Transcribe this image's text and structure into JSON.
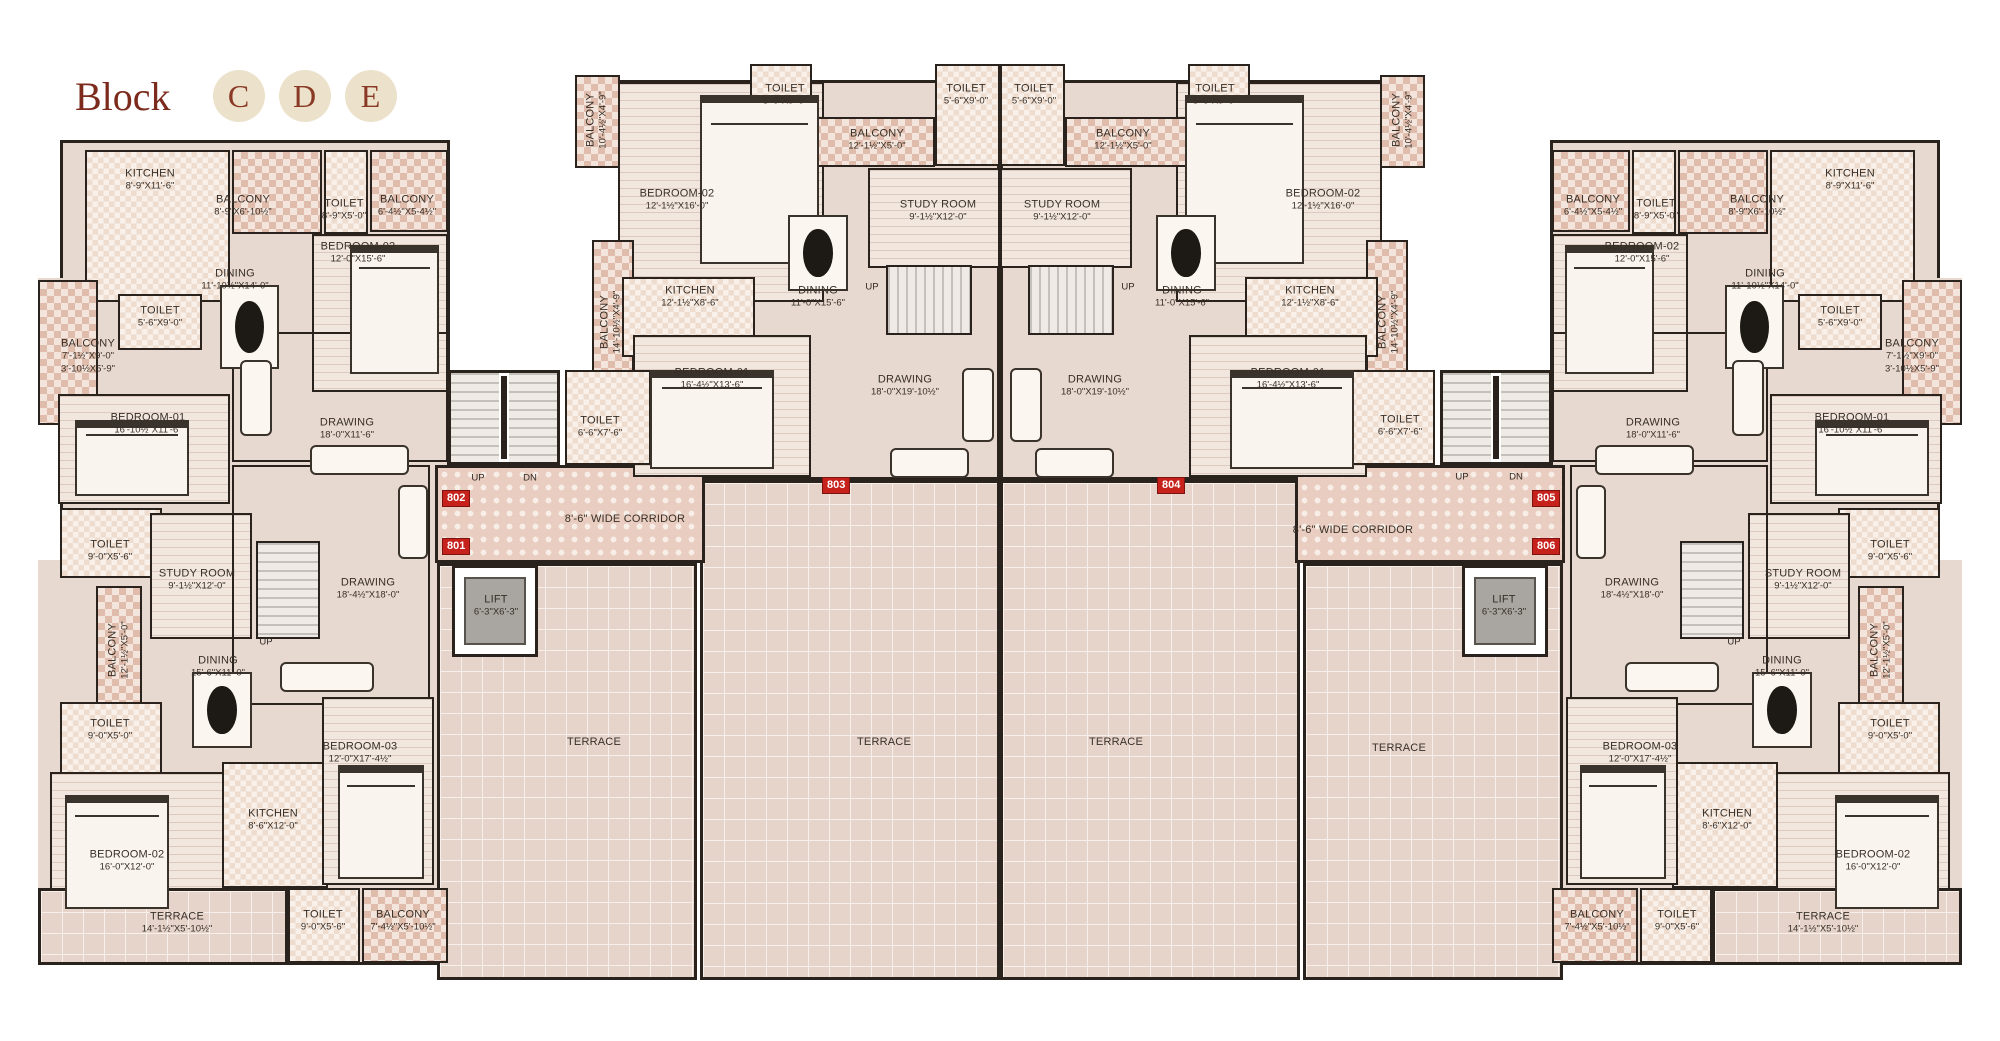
{
  "title": {
    "text": "Block",
    "badges": [
      "C",
      "D",
      "E"
    ]
  },
  "colors": {
    "accent": "#7b2a1c",
    "badge_bg": "#ece2cb",
    "unit_badge": "#c6211b",
    "wall": "#2a231d"
  },
  "unit_badges": [
    {
      "n": "802",
      "x": 442,
      "y": 490
    },
    {
      "n": "801",
      "x": 442,
      "y": 538
    },
    {
      "n": "803",
      "x": 822,
      "y": 477
    },
    {
      "n": "804",
      "x": 1157,
      "y": 477
    },
    {
      "n": "805",
      "x": 1532,
      "y": 490
    },
    {
      "n": "806",
      "x": 1532,
      "y": 538
    }
  ],
  "stair_labels": [
    {
      "t": "UP",
      "x": 478,
      "y": 478
    },
    {
      "t": "DN",
      "x": 530,
      "y": 478
    },
    {
      "t": "UP",
      "x": 1462,
      "y": 477
    },
    {
      "t": "DN",
      "x": 1516,
      "y": 477
    },
    {
      "t": "UP",
      "x": 872,
      "y": 287
    },
    {
      "t": "UP",
      "x": 1128,
      "y": 287
    },
    {
      "t": "UP",
      "x": 266,
      "y": 642
    },
    {
      "t": "UP",
      "x": 1734,
      "y": 642
    }
  ],
  "labels": [
    {
      "n": "KITCHEN",
      "d": "8'-9\"X11'-6\"",
      "x": 150,
      "y": 180
    },
    {
      "n": "BALCONY",
      "d": "8'-9\"X6'-10½\"",
      "x": 243,
      "y": 206
    },
    {
      "n": "TOILET",
      "d": "8'-9\"X5'-0\"",
      "x": 344,
      "y": 210
    },
    {
      "n": "BALCONY",
      "d": "6'-4½\"X5-4½\"",
      "x": 407,
      "y": 206
    },
    {
      "n": "BEDROOM-02",
      "d": "12'-0\"X15'-6\"",
      "x": 358,
      "y": 253
    },
    {
      "n": "DINING",
      "d": "11'-10½\"X14'-0\"",
      "x": 235,
      "y": 280
    },
    {
      "n": "TOILET",
      "d": "5'-6\"X9'-0\"",
      "x": 160,
      "y": 317
    },
    {
      "n": "BALCONY",
      "d": "7'-1½\"X9'-0\"",
      "d2": "3'-10½X5'-9\"",
      "x": 88,
      "y": 356
    },
    {
      "n": "BEDROOM-01",
      "d": "16'-10½\"X11'-6\"",
      "x": 148,
      "y": 424
    },
    {
      "n": "DRAWING",
      "d": "18'-0\"X11'-6\"",
      "x": 347,
      "y": 429
    },
    {
      "n": "TOILET",
      "d": "9'-0\"X5'-6\"",
      "x": 110,
      "y": 551
    },
    {
      "n": "STUDY ROOM",
      "d": "9'-1½\"X12'-0\"",
      "x": 197,
      "y": 580
    },
    {
      "n": "BALCONY",
      "d": "12'-1½\"X5'-0\"",
      "x": 119,
      "y": 650,
      "rot": true
    },
    {
      "n": "DINING",
      "d": "15'-6\"X11'-0\"",
      "x": 218,
      "y": 667
    },
    {
      "n": "TOILET",
      "d": "9'-0\"X5'-0\"",
      "x": 110,
      "y": 730
    },
    {
      "n": "DRAWING",
      "d": "18'-4½\"X18'-0\"",
      "x": 368,
      "y": 589
    },
    {
      "n": "BEDROOM-03",
      "d": "12'-0\"X17'-4½\"",
      "x": 360,
      "y": 753
    },
    {
      "n": "LIFT",
      "d": "6'-3\"X6'-3\"",
      "x": 496,
      "y": 606
    },
    {
      "n": "BEDROOM-02",
      "d": "16'-0\"X12'-0\"",
      "x": 127,
      "y": 861
    },
    {
      "n": "KITCHEN",
      "d": "8'-6\"X12'-0\"",
      "x": 273,
      "y": 820
    },
    {
      "n": "TERRACE",
      "d": "14'-1½\"X5'-10½\"",
      "x": 177,
      "y": 923
    },
    {
      "n": "TOILET",
      "d": "9'-0\"X5'-6\"",
      "x": 323,
      "y": 921
    },
    {
      "n": "BALCONY",
      "d": "7'-4½\"X5'-10½\"",
      "x": 403,
      "y": 921
    },
    {
      "n": "BALCONY",
      "d": "10'-4½\"X4'-9\"",
      "x": 597,
      "y": 120,
      "rot": true
    },
    {
      "n": "BEDROOM-02",
      "d": "12'-1½\"X16'-0\"",
      "x": 677,
      "y": 200
    },
    {
      "n": "TOILET",
      "d": "5'-0\"X9'-0\"",
      "x": 785,
      "y": 95
    },
    {
      "n": "BALCONY",
      "d": "12'-1½\"X5'-0\"",
      "x": 877,
      "y": 140
    },
    {
      "n": "TOILET",
      "d": "5'-6\"X9'-0\"",
      "x": 966,
      "y": 95
    },
    {
      "n": "STUDY ROOM",
      "d": "9'-1½\"X12'-0\"",
      "x": 938,
      "y": 211
    },
    {
      "n": "KITCHEN",
      "d": "12'-1½\"X8'-6\"",
      "x": 690,
      "y": 297
    },
    {
      "n": "DINING",
      "d": "11'-0\"X15'-6\"",
      "x": 818,
      "y": 297
    },
    {
      "n": "BALCONY",
      "d": "14'-10½\"X4'-9\"",
      "x": 611,
      "y": 322,
      "rot": true
    },
    {
      "n": "BEDROOM-01",
      "d": "16'-4½\"X13'-6\"",
      "x": 712,
      "y": 379
    },
    {
      "n": "DRAWING",
      "d": "18'-0\"X19'-10½\"",
      "x": 905,
      "y": 386
    },
    {
      "n": "TOILET",
      "d": "6'-6\"X7'-6\"",
      "x": 600,
      "y": 427
    },
    {
      "n": "BALCONY",
      "d": "10'-4½\"X4'-9\"",
      "x": 1403,
      "y": 120,
      "rot": true
    },
    {
      "n": "BEDROOM-02",
      "d": "12'-1½\"X16'-0\"",
      "x": 1323,
      "y": 200
    },
    {
      "n": "TOILET",
      "d": "5'-0\"X9'-0\"",
      "x": 1215,
      "y": 95
    },
    {
      "n": "BALCONY",
      "d": "12'-1½\"X5'-0\"",
      "x": 1123,
      "y": 140
    },
    {
      "n": "TOILET",
      "d": "5'-6\"X9'-0\"",
      "x": 1034,
      "y": 95
    },
    {
      "n": "STUDY ROOM",
      "d": "9'-1½\"X12'-0\"",
      "x": 1062,
      "y": 211
    },
    {
      "n": "KITCHEN",
      "d": "12'-1½\"X8'-6\"",
      "x": 1310,
      "y": 297
    },
    {
      "n": "DINING",
      "d": "11'-0\"X15'-6\"",
      "x": 1182,
      "y": 297
    },
    {
      "n": "BALCONY",
      "d": "14'-10½\"X4'-9\"",
      "x": 1389,
      "y": 322,
      "rot": true
    },
    {
      "n": "BEDROOM-01",
      "d": "16'-4½\"X13'-6\"",
      "x": 1288,
      "y": 379
    },
    {
      "n": "DRAWING",
      "d": "18'-0\"X19'-10½\"",
      "x": 1095,
      "y": 386
    },
    {
      "n": "TOILET",
      "d": "6'-6\"X7'-6\"",
      "x": 1400,
      "y": 426
    },
    {
      "n": "KITCHEN",
      "d": "8'-9\"X11'-6\"",
      "x": 1850,
      "y": 180
    },
    {
      "n": "BALCONY",
      "d": "8'-9\"X6'-10½\"",
      "x": 1757,
      "y": 206
    },
    {
      "n": "TOILET",
      "d": "8'-9\"X5'-0\"",
      "x": 1656,
      "y": 210
    },
    {
      "n": "BALCONY",
      "d": "6'-4½\"X5-4½\"",
      "x": 1593,
      "y": 206
    },
    {
      "n": "BEDROOM-02",
      "d": "12'-0\"X15'-6\"",
      "x": 1642,
      "y": 253
    },
    {
      "n": "DINING",
      "d": "11'-10½\"X14'-0\"",
      "x": 1765,
      "y": 280
    },
    {
      "n": "TOILET",
      "d": "5'-6\"X9'-0\"",
      "x": 1840,
      "y": 317
    },
    {
      "n": "BALCONY",
      "d": "7'-1½\"X9'-0\"",
      "d2": "3'-10½X5'-9\"",
      "x": 1912,
      "y": 356
    },
    {
      "n": "BEDROOM-01",
      "d": "16'-10½\"X11'-6\"",
      "x": 1852,
      "y": 424
    },
    {
      "n": "DRAWING",
      "d": "18'-0\"X11'-6\"",
      "x": 1653,
      "y": 429
    },
    {
      "n": "TOILET",
      "d": "9'-0\"X5'-6\"",
      "x": 1890,
      "y": 551
    },
    {
      "n": "STUDY ROOM",
      "d": "9'-1½\"X12'-0\"",
      "x": 1803,
      "y": 580
    },
    {
      "n": "BALCONY",
      "d": "12'-1½\"X5'-0\"",
      "x": 1881,
      "y": 650,
      "rot": true
    },
    {
      "n": "DINING",
      "d": "15'-6\"X11'-0\"",
      "x": 1782,
      "y": 667
    },
    {
      "n": "TOILET",
      "d": "9'-0\"X5'-0\"",
      "x": 1890,
      "y": 730
    },
    {
      "n": "DRAWING",
      "d": "18'-4½\"X18'-0\"",
      "x": 1632,
      "y": 589
    },
    {
      "n": "BEDROOM-03",
      "d": "12'-0\"X17'-4½\"",
      "x": 1640,
      "y": 753
    },
    {
      "n": "LIFT",
      "d": "6'-3\"X6'-3\"",
      "x": 1504,
      "y": 606
    },
    {
      "n": "BEDROOM-02",
      "d": "16'-0\"X12'-0\"",
      "x": 1873,
      "y": 861
    },
    {
      "n": "KITCHEN",
      "d": "8'-6\"X12'-0\"",
      "x": 1727,
      "y": 820
    },
    {
      "n": "TERRACE",
      "d": "14'-1½\"X5'-10½\"",
      "x": 1823,
      "y": 923
    },
    {
      "n": "TOILET",
      "d": "9'-0\"X5'-6\"",
      "x": 1677,
      "y": 921
    },
    {
      "n": "BALCONY",
      "d": "7'-4½\"X5'-10½\"",
      "x": 1597,
      "y": 921
    },
    {
      "n": "8'-6\" WIDE CORRIDOR",
      "x": 625,
      "y": 519
    },
    {
      "n": "8'-6\" WIDE CORRIDOR",
      "x": 1353,
      "y": 530
    },
    {
      "n": "TERRACE",
      "x": 594,
      "y": 742
    },
    {
      "n": "TERRACE",
      "x": 884,
      "y": 742
    },
    {
      "n": "TERRACE",
      "x": 1116,
      "y": 742
    },
    {
      "n": "TERRACE",
      "x": 1399,
      "y": 748
    }
  ]
}
